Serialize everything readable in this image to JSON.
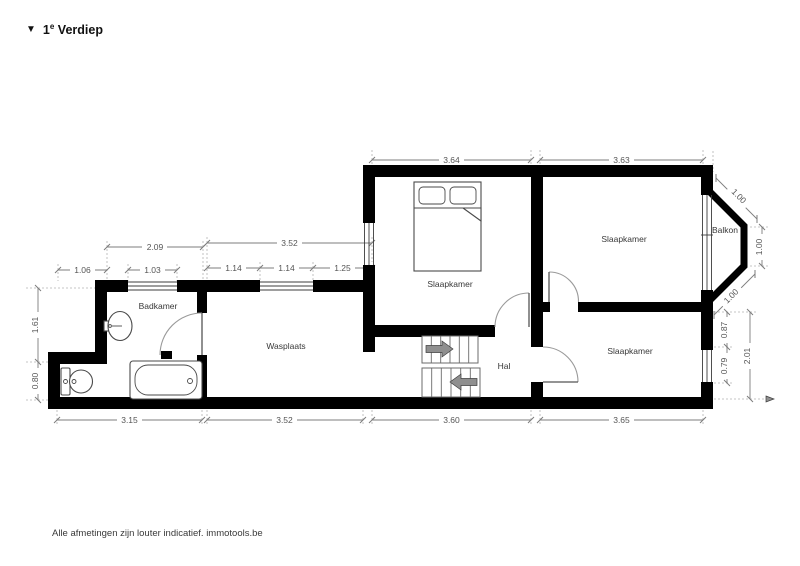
{
  "page": {
    "title": {
      "marker": "▼",
      "floor_number": "1",
      "floor_sup": "e",
      "floor_name": "Verdiep"
    },
    "footer": "Alle afmetingen zijn louter indicatief. immotools.be"
  },
  "rooms": {
    "badkamer": "Badkamer",
    "wasplaats": "Wasplaats",
    "slaapkamer_middle": "Slaapkamer",
    "slaapkamer_top_right": "Slaapkamer",
    "slaapkamer_bottom_right": "Slaapkamer",
    "hal": "Hal",
    "balkon": "Balkon"
  },
  "dimensions": {
    "top": [
      "3.64",
      "3.63"
    ],
    "badkamer_top": [
      "2.09",
      "1.06",
      "1.03"
    ],
    "wasplaats_top": [
      "3.52",
      "1.14",
      "1.14",
      "1.25"
    ],
    "left": [
      "1.61",
      "0.80"
    ],
    "bottom": [
      "3.15",
      "3.52",
      "3.60",
      "3.65"
    ],
    "balcony": [
      "1.00",
      "1.00",
      "1.00"
    ],
    "right": [
      "0.87",
      "0.79",
      "2.01"
    ]
  },
  "colors": {
    "wall": "#000000",
    "dim_line": "#7d7d7d",
    "dim_text": "#555555",
    "room_text": "#383838",
    "stairs_arrow": "#8f8f8f",
    "background": "#ffffff"
  }
}
